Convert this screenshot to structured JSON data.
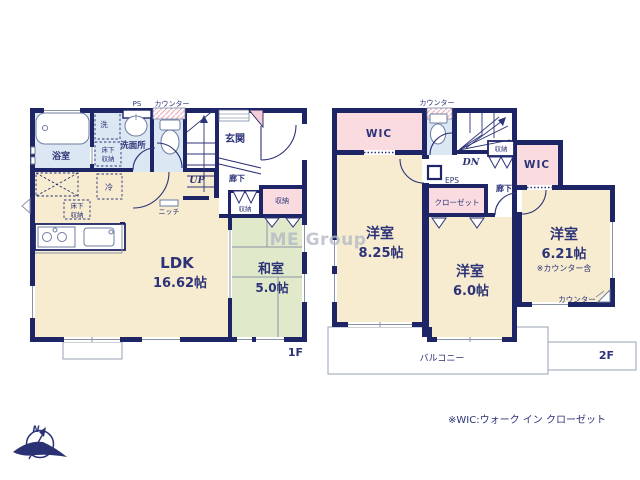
{
  "meta": {
    "floor1_label": "1F",
    "floor2_label": "2F",
    "note": "※WIC:ウォーク イン クローゼット",
    "watermark": "ME Group",
    "compass_n": "N"
  },
  "f1": {
    "ps": "PS",
    "counter": "カウンター",
    "bathroom": "浴室",
    "laundry": "洗",
    "washroom": "洗面所",
    "underfloor1_l1": "床下",
    "underfloor1_l2": "収納",
    "underfloor2_l1": "床下",
    "underfloor2_l2": "収納",
    "fridge": "冷",
    "niche": "ニッチ",
    "up": "UP",
    "genkan": "玄関",
    "hallway": "廊下",
    "storage_small": "収納",
    "storage_pink": "収納",
    "ldk": "LDK",
    "ldk_size": "16.62帖",
    "washitsu": "和室",
    "washitsu_size": "5.0帖"
  },
  "f2": {
    "counter_top": "カウンター",
    "wic_left": "WIC",
    "wic_right": "WIC",
    "dn": "DN",
    "storage": "収納",
    "eps": "EPS",
    "hallway": "廊下",
    "closet": "クローゼット",
    "room1": "洋室",
    "room1_size": "8.25帖",
    "room2": "洋室",
    "room2_size": "6.0帖",
    "room3": "洋室",
    "room3_size": "6.21帖",
    "room3_note": "※カウンター含",
    "counter_desk": "カウンター",
    "balcony": "バルコニー"
  }
}
